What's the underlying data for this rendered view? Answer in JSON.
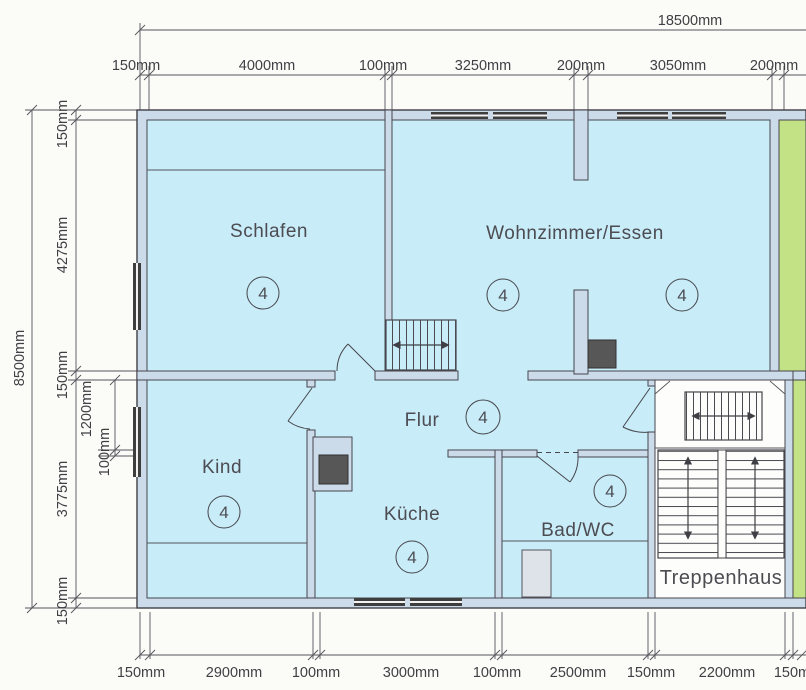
{
  "drawing": {
    "type": "floor-plan-scan",
    "overall": {
      "width": "18500mm",
      "height": "8500mm"
    },
    "top_chain": [
      "150mm",
      "4000mm",
      "100mm",
      "3250mm",
      "200mm",
      "3050mm",
      "200mm"
    ],
    "left_chain": [
      "150mm",
      "4275mm",
      "150mm",
      "3775mm",
      "150mm"
    ],
    "left_subchain": [
      "1200mm",
      "100mm"
    ],
    "bottom_chain": [
      "150mm",
      "2900mm",
      "100mm",
      "3000mm",
      "100mm",
      "2500mm",
      "150mm",
      "2200mm",
      "150mm"
    ],
    "rooms": {
      "schlafen": {
        "label": "Schlafen",
        "number": "4"
      },
      "wohnzimmer": {
        "label": "Wohnzimmer/Essen",
        "number_left": "4",
        "number_right": "4"
      },
      "kind": {
        "label": "Kind",
        "number": "4"
      },
      "flur": {
        "label": "Flur",
        "number": "4"
      },
      "kueche": {
        "label": "Küche",
        "number": "4"
      },
      "bad": {
        "label": "Bad/WC",
        "number": "4"
      },
      "treppenhaus": {
        "label": "Treppenhaus"
      }
    },
    "colors": {
      "room_fill": "#c8ecf8",
      "wall_fill": "#ccdbea",
      "neighbor_fill": "#c2e285",
      "stairwell_fill": "#fdfdfc",
      "chimney_fill": "#575757",
      "tub_fill": "#dde3e8",
      "line": "#3f3f46"
    }
  }
}
